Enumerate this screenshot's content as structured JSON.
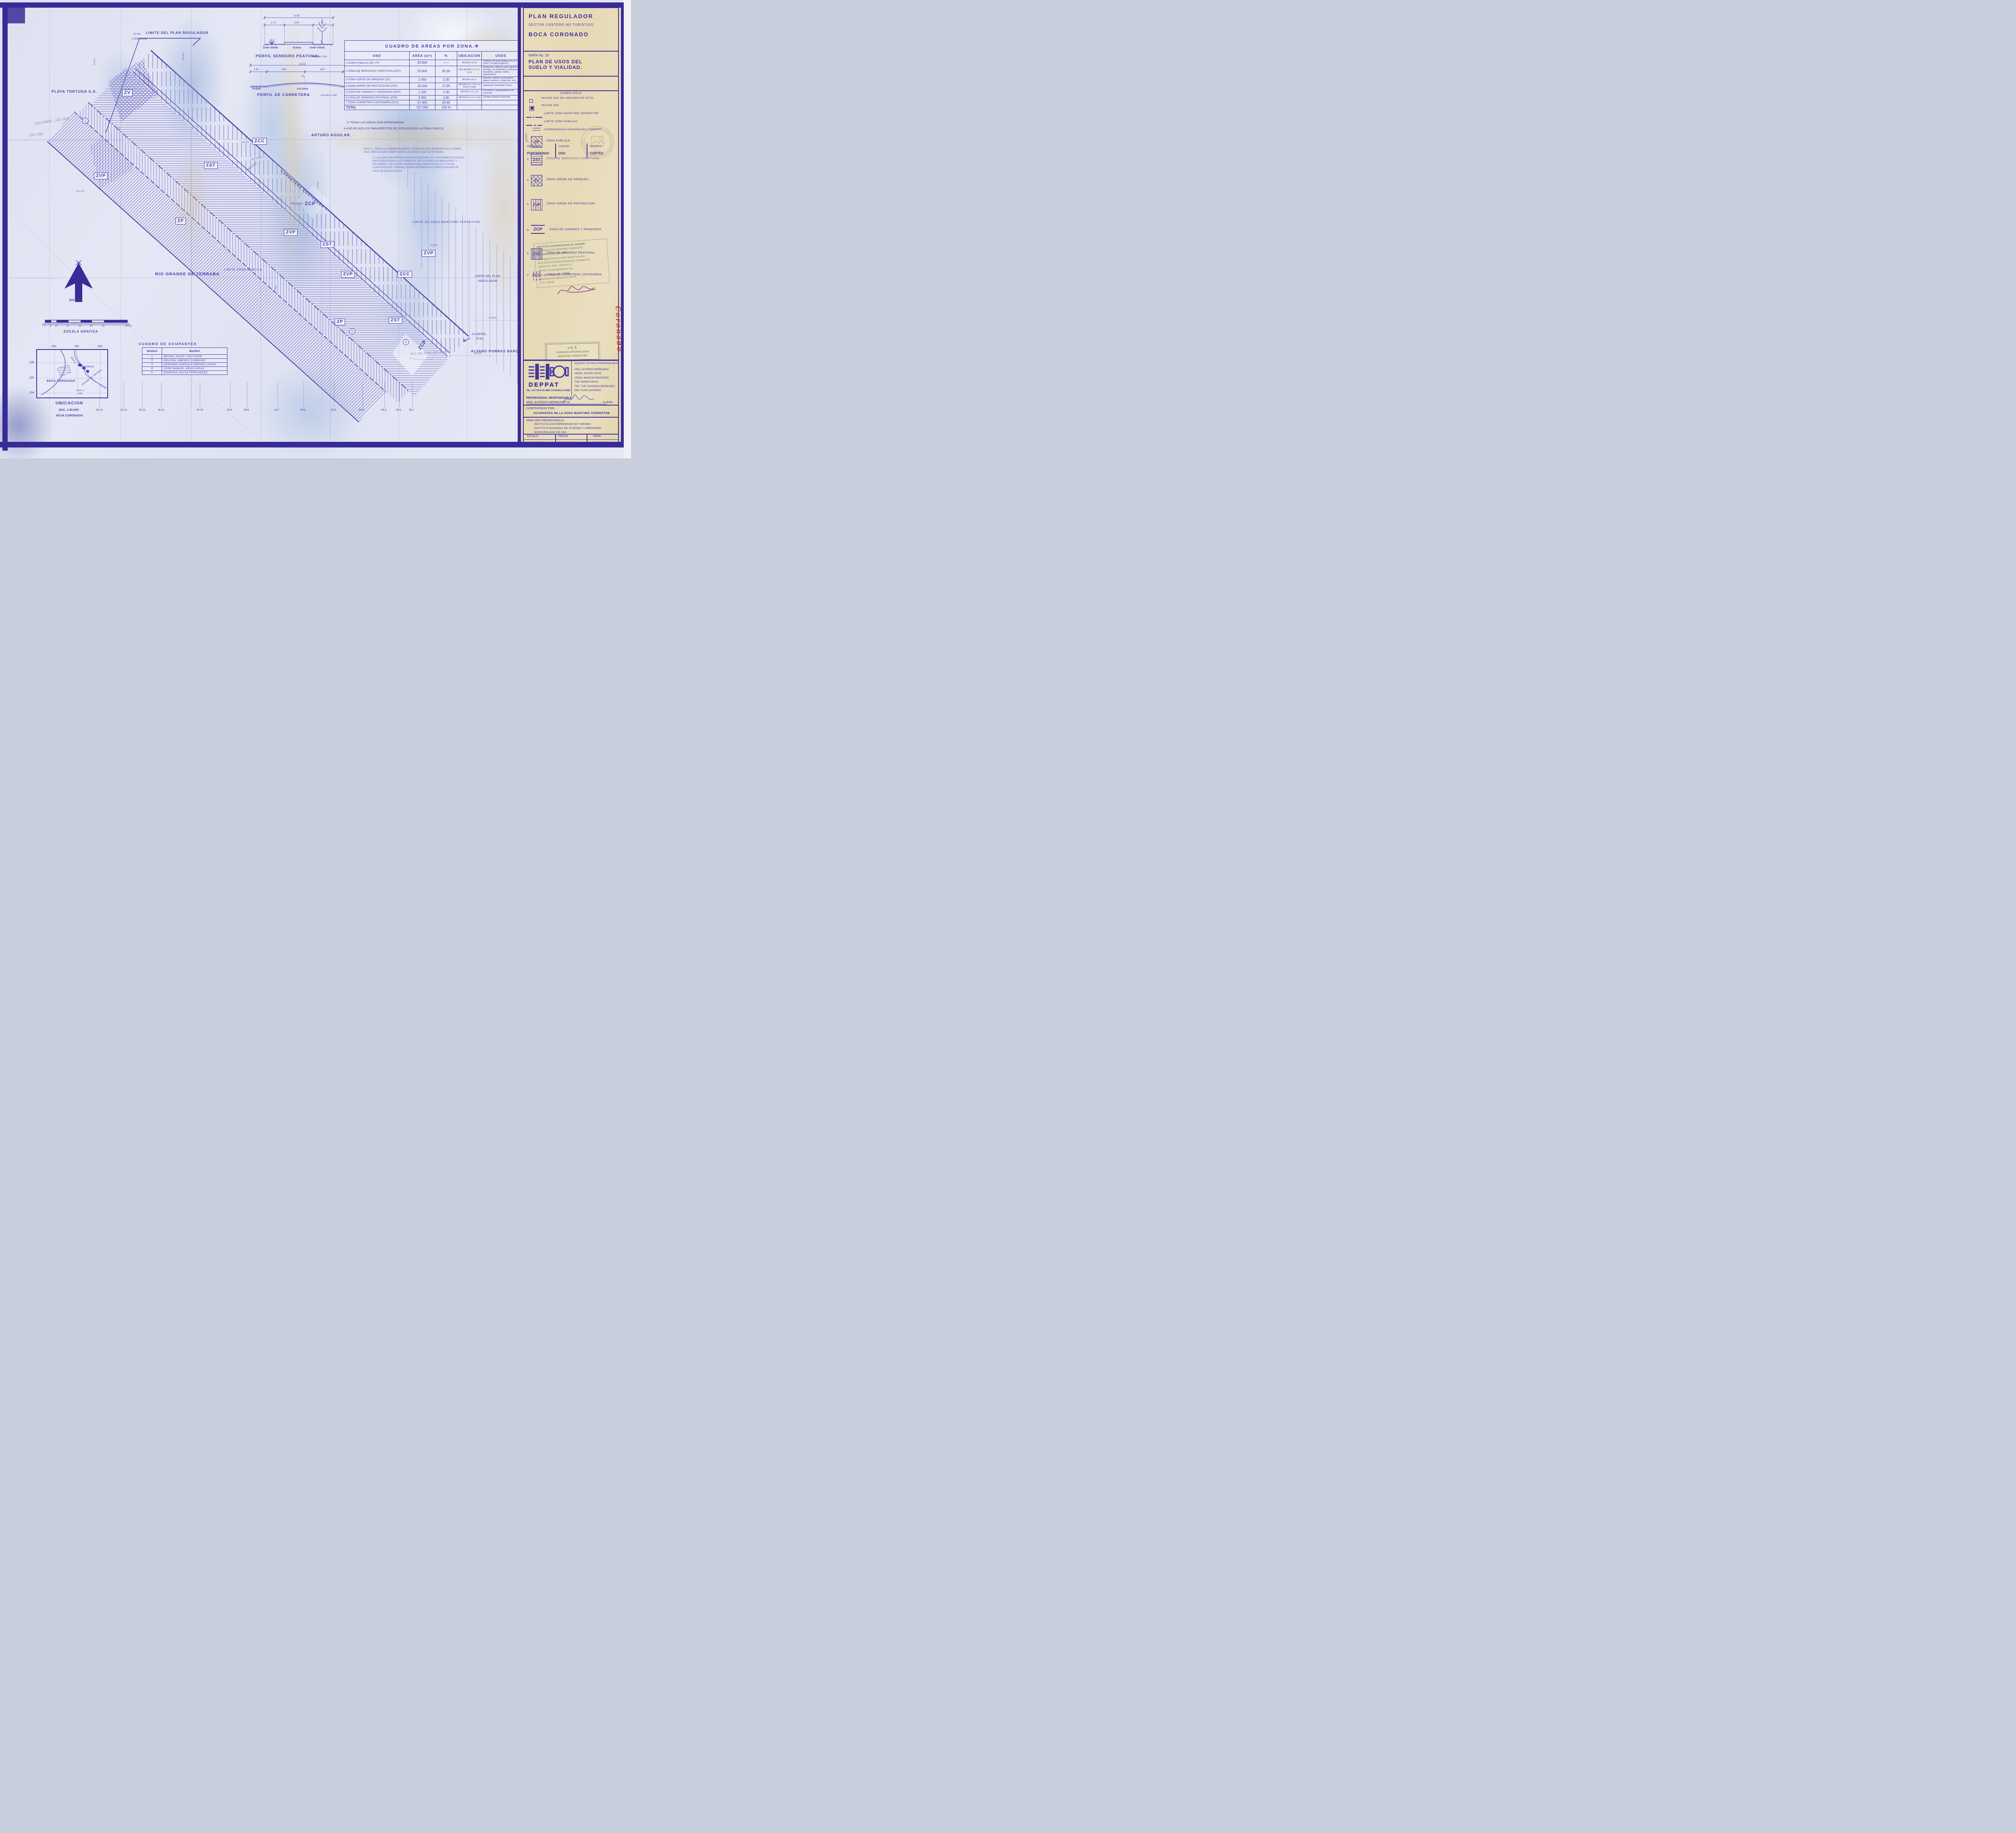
{
  "panel": {
    "title": "PLAN REGULADOR",
    "subtitle": "SECTOR COSTERO NO TURISTICO",
    "area_name": "BOCA CORONADO",
    "mapa_no": "MAPA No. 20",
    "map_title_line1": "PLAN DE USOS DEL",
    "map_title_line2": "SUELO Y VIALIDAD.",
    "provincia_label": "PROVINCIA",
    "provincia": "PUNTARENAS",
    "canton_label": "CANTON",
    "canton": "OSA",
    "distrito_label": "DISTRITO",
    "distrito": "CORTES",
    "simbologia_title": "SIMBOLOGIA",
    "simbologia": [
      {
        "label": "MOJON IGN NO UBICADO EN SITIO"
      },
      {
        "label": "MOJON IGN"
      },
      {
        "label": "LIMITE ZONA MARITIMO TERRESTRE"
      },
      {
        "label": "LIMITE ZONA PUBLICA"
      },
      {
        "label": "COORDENADAS NACIONALES LAMBERT",
        "coord_v": "502000",
        "coord_h": "335600"
      }
    ],
    "zones": [
      {
        "num": "1",
        "code": "ZP",
        "label": "ZONA PUBLICA."
      },
      {
        "num": "2",
        "code": "ZST",
        "label": "ZONA DE SERVICIOS TURISTICOS"
      },
      {
        "num": "3",
        "code": "ZV",
        "label": "ZONA VERDE DE PARQUES."
      },
      {
        "num": "4",
        "code": "ZVP",
        "label": "ZONA VERDE DE PROTECCION."
      },
      {
        "num": "5",
        "code": "ZCP",
        "label": "ZONA DE CAMINOS Y PARQUEOS."
      },
      {
        "num": "6",
        "code": "ZSP",
        "label": "ZONA DE SENDERO PEATONAL."
      },
      {
        "num": "7",
        "code": "ZCC",
        "label": "ZONA DE CARRETERA COSTANERA."
      }
    ],
    "stamp": {
      "l1": "INSTITUTO COSTARRICENSE DE TURISMO",
      "l2": "COMISION ZONA MARITIMO TERRESTRE",
      "l3": "PLANIFICACION COSTERA",
      "l4": "APROBADA POR LA JUNTA DIRECTIVA DEL",
      "l5": "INSTITUTO COSTARRICENSE DE TURISMO EN",
      "l6": "SESION No. 4642 , ARTICULO 5",
      "l7": "INCISO XV   CELEBRADA EL DIA",
      "l8": "20 de mayo de 1996",
      "l9": "COMUNICADO MEDIANTE OFICIO",
      "l10": "S.J.D.- 528-96"
    },
    "ict_round": {
      "center": "I.C.T.",
      "ring": "DIRECCION DE PLANEAMIENTO Y DESARROLLO TURISTICO"
    },
    "ict_box": {
      "line1": "I. C. T.",
      "line2": "COMISION INTERNA ZONA",
      "line3": "MARITIMO TERRESTRE"
    },
    "deppat": {
      "name": "DEPPAT",
      "tel": "TEL. 24-7104/ 25-4881  FAX(506) 53-9282",
      "equipo_title": "EQUIPO TECNICO RESPONSABLE",
      "equipo": [
        "ARQ. ALFREDO BERMUDEZ",
        "GEOG. RAFAEL ARCE",
        "GEOG. MARCOS MONTERO",
        "TOP. MARIO ARAYA",
        "TEC. TUR. EUGENIO BERMUDEZ",
        "DIB. PILAR LEANDRO"
      ],
      "prof_label": "PROFESIONAL RESPONSABLE:",
      "prof_name": "ARQ. ALFREDO BERMUDEZ M.",
      "prof_reg": "A-4043."
    },
    "contratado_label": "CONTRATADO  POR:",
    "contratado": "OCUPANTES DE LA ZONA MARITIMO TERRESTRE",
    "presentado_label": "PARA SER PRESENTADO A:",
    "presentado": [
      "INSTITUTO COSTARRICENSE DE TURISMO",
      "INSTITUTO NACIONAL DE VIVIENDA Y URBANISMO",
      "MUNICIPALIDAD DE OSA"
    ],
    "footer": {
      "escala_label": "ESCALA",
      "escala": "1:1000",
      "fecha_label": "FECHA",
      "fecha": "JULIO 1.993",
      "mapa_label": "MAPA",
      "mapa": "20/20"
    },
    "red_note": "Boca Coronado"
  },
  "areas": {
    "title": "CUADRO DE AREAS POR ZONA.✳",
    "headers": [
      "USO",
      "AREA (m²)",
      "%",
      "UBICACION",
      "USOS"
    ],
    "rows": [
      {
        "uso": "1 ZONA PUBLICA (ZP) ✳✳",
        "area": "33.900",
        "pct": "——",
        "ubi": "MOJON 1 al 14",
        "usos": "TODOS LOS QUE SEÑALA LA LEY 6043 Y SU REGLAMENTO"
      },
      {
        "uso": "2 ZONA DE SERVICIOS TURISTICOS (ZST)",
        "area": "53.800",
        "pct": "50,30",
        "ubi": "DEL MOJON 1-5, 6-7, 8-14",
        "usos": "Restaurant, cafeteria, soda, agencia de viajes, art. fotograficos, artesania, lavanderia, cabinas, hoteles, apartamentos"
      },
      {
        "uso": "3 ZONA VERDE DE PARQUES (ZV)",
        "area": "2.450",
        "pct": "2,30",
        "ubi": "MOJON 14 y 1",
        "usos": "Deportes, arboles ornamentales, juegos, senderos, refugio obv. aves."
      },
      {
        "uso": "4 ZONA VERDE DE PROTECCION (ZVP)",
        "area": "19.200",
        "pct": "17,95",
        "ubi": "MOJON 5-6, 7-14 y 14 frente a talud",
        "usos": "Vegetación ornamental y flores"
      },
      {
        "uso": "5 ZONA DE CAMINOS Y PARQUEOS (ZCP)",
        "area": "1.100",
        "pct": "1,00",
        "ubi": "MOJON 1, 6, y 13",
        "usos": "Circulación y aparqueamiento de vehículos"
      },
      {
        "uso": "6 ZONA DE SENDERO PEATONAL (ZSP)",
        "area": "3.050",
        "pct": "2,85",
        "ubi": "MOJON 1-5, 6-7, 9-14",
        "usos": "Sendero peatonal arborizado"
      },
      {
        "uso": "7 ZONA CARRETERA COSTANERA (ZCC)",
        "area": "27.400",
        "pct": "25,60",
        "ubi": "",
        "usos": ""
      }
    ],
    "total_label": "TOTAL",
    "total_area": "107.000",
    "total_pct": "100 %",
    "note1": "✳ TODAS LAS AREAS SON APROXIMADAS",
    "note2": "✳✳NO SE INCLUYE PARA EFECTOS DE TOTALIZACION LA ZONA PUBLICA"
  },
  "ocupantes": {
    "title": "CUADRO  DE  OCUPANTES",
    "headers": [
      "Número",
      "Nombre"
    ],
    "rows": [
      {
        "num": "1",
        "nombre": "BRUNO JOSEF LÖSTCHER"
      },
      {
        "num": "2",
        "nombre": "NELSON JIMENEZ ZUMBADO"
      },
      {
        "num": "3",
        "nombre": "GERARDO ENRIQUE BRENES ARIAS"
      },
      {
        "num": "4",
        "nombre": "JOSE MANUEL ARIAS ARIAS"
      },
      {
        "num": "5",
        "nombre": "RODRIGO SALAS FERNANDEZ"
      }
    ]
  },
  "profiles": {
    "sendero": {
      "title": "PERFIL SENDERO PEATONAL",
      "escala": "ESCALA 1:100",
      "dim_total": "6.00",
      "dims": [
        "1.75",
        "2.50",
        "1.75"
      ],
      "labels": [
        "ZONA VERDE",
        "ACERA",
        "ZONA VERDE"
      ]
    },
    "carretera": {
      "title": "PERFIL DE CARRETERA",
      "escala": "ESCALA.1:100",
      "dim_total": "10.00",
      "dims": [
        "1.50",
        "3.50",
        "3.50",
        "1.50"
      ],
      "labels": [
        "ACERA",
        "CALZADA",
        "ACERA"
      ],
      "cl": "CL"
    }
  },
  "ubicacion": {
    "top_coords": [
      "500",
      "501",
      "502"
    ],
    "left_coords": [
      "336",
      "335",
      "334"
    ],
    "estero": "Estero",
    "chacara": "Chácara",
    "boca": "BOCA CORONADO",
    "rio": "Grande de Térraba",
    "areno": "Areno y",
    "lodo": "lodo",
    "caption": "UBICACION",
    "esc": "ESC. 1:50.000",
    "hoja": "HOJA CORONADO"
  },
  "map": {
    "limite_plan_top": "LIMITE DEL PLAN REGULADOR",
    "km41_l1": "41 Km.",
    "km41_l2": "A DOMINICAL",
    "playa": "PLAYA TORTUGA S.A.",
    "arturo": "ARTURO AGUILAR.",
    "rio": "RIO GRANDE DE TERRABA",
    "alvaro": "ALVARO PORRAS BARQUERO.",
    "a_cortes_l1": "A CORTES",
    "a_cortes_l2": "20 km.",
    "limite_zmt": "LIMITE  DE ZONA MARITIMO TERRESTRE",
    "limite_zp": "LIMITE ZONA PUBLICA",
    "limite_plan_r1": "LIMITE DEL PLAN",
    "limite_plan_r2": "REGULADOR",
    "carretera": "CARRETERA COSTANERA",
    "relleno": "RELLENO",
    "alcantarilla": "Alcantarilla",
    "agua": "AGUA",
    "norte": "NORTE",
    "escala_grafica": "ESCALA GRAFICA",
    "scale_ticks": [
      "0",
      "5",
      "10",
      "20",
      "30",
      "40",
      "50"
    ],
    "scale_end": "100 m.",
    "nota_l1": "NOTA: 1- TODAS LAS OBSERVACIONES Y DETALLES QUE APARECEN EN LA LAMINA 20/20, PREVALECEN SOBRE TODOS LOS DEMAS QUE SE OPONGAN.",
    "nota_l2": "2- LAS ZONAS DE PROTECCION DE ALCANTARILLAS Y ESCORRENTIAS ESTAN PROTEGIDAS POR LA LEY FORESTAL, INCLUYENDO LOS MANGLARES Y ESTUARIOS, LOS CUALES TENDRAN UNA LIMITACION DE 20 m. DE NO CONSTRUCCION, TOMANDO COMO REFERENCIA EL ESPEJO MAXIMO DE AGUA DE DICHAS ZONAS.",
    "hw_coord1": "335.698N - 501.005",
    "hw_coord2": "335.700",
    "hw_coord3": "M-1  335.305N- 501.533 E",
    "coords": {
      "c335700": "335700",
      "c501100": "501100",
      "c501400": "501400",
      "c335300": "335300",
      "c335400": "335400",
      "c500000": "500000",
      "c335000": "335.000",
      "c335800": "335800"
    },
    "circled": [
      "1",
      "5",
      "3"
    ],
    "tag_zcp": "ZCP",
    "tags": [
      "ZV",
      "ZVP",
      "ZCC",
      "ZST",
      "ZP",
      "ZVP",
      "ZST",
      "ZVP",
      "ZCC",
      "ZVP",
      "ZP",
      "ZST"
    ],
    "mojones": [
      "M-14",
      "M-13",
      "M-12",
      "M-11",
      "M-10",
      "M-9",
      "M-8",
      "M-7",
      "M-6",
      "M-5",
      "M-4",
      "M-3",
      "M-2",
      "M-1"
    ]
  }
}
